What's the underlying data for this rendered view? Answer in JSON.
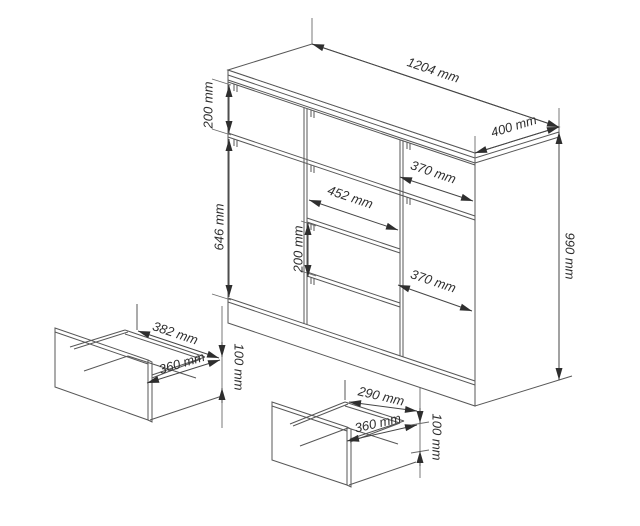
{
  "diagram": {
    "kind": "furniture dimension drawing (chest of drawers with two pulled-out drawer details)",
    "colors": {
      "line": "#575757",
      "dimension_line": "#454545",
      "text": "#2e2e2e",
      "background": "#ffffff"
    },
    "cabinet": {
      "width": "1204 mm",
      "depth": "400 mm",
      "height": "990 mm",
      "top_drawer_row_height": "200 mm",
      "door_height": "646 mm",
      "right_top_drawer_width": "370 mm",
      "middle_drawers_width": "452 mm",
      "middle_drawer_height": "200 mm",
      "right_door_width": "370 mm"
    },
    "left_drawer_detail": {
      "width": "382 mm",
      "depth": "360 mm",
      "height": "100 mm"
    },
    "bottom_drawer_detail": {
      "width": "290 mm",
      "depth": "360 mm",
      "height": "100 mm"
    }
  }
}
